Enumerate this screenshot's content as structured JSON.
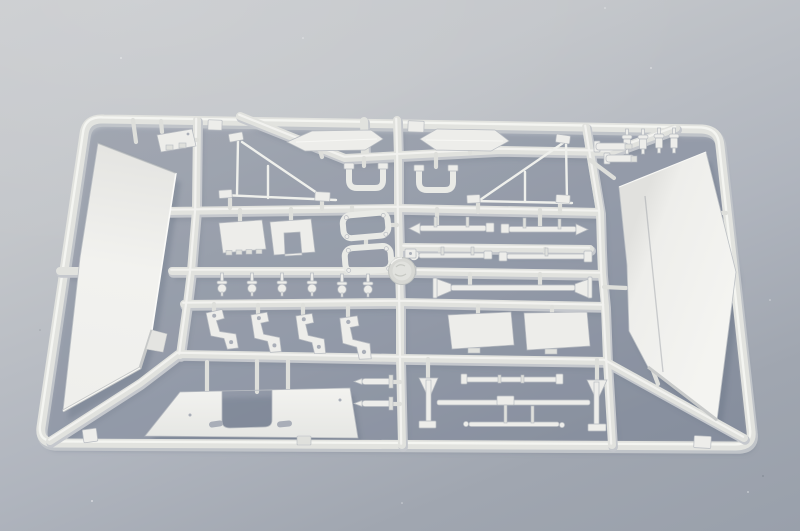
{
  "meta": {
    "domain": "natural-image",
    "description": "Overhead photograph of an unassembled light-gray injection-molded plastic model kit sprue (parts tree) lying on a blue-gray studio surface, lit from the upper left, frame tilted in slight perspective",
    "subject": "plastic model kit sprue with armored-vehicle parts",
    "text_visible": "none"
  },
  "palette": {
    "background_top": "#c8cacd",
    "background_bottom": "#99a0ab",
    "interior_tint": "rgba(115,130,155,0.14)",
    "plastic_bright": "#f5f5f2",
    "plastic_main": "#e1e2de",
    "plastic_mid": "#dfe0dc",
    "plastic_shadow_edge": "#c6c8c8",
    "medallion_fill": "#d7d8d4",
    "cast_shadow": "rgba(95,105,125,0.30)"
  },
  "sprue": {
    "frame_shape": "rounded-rectangle runner frame, wider at bottom due to camera perspective",
    "grid": {
      "horizontal_runners": 5,
      "vertical_runners": 3,
      "corner_diagonals": 4
    },
    "medallion": {
      "shape": "embossed circular maker's stamp",
      "position": "crossing of the central vertical and middle horizontal runner"
    }
  },
  "parts": [
    {
      "id": "large-panel-left",
      "label": "Large tapered side panel",
      "count": 1,
      "location": "left column"
    },
    {
      "id": "large-panel-right",
      "label": "Large tapered side panel (mirrored)",
      "count": 1,
      "location": "right column"
    },
    {
      "id": "floor-plate",
      "label": "Wide floor plate with arched cut-out and two slots",
      "count": 1,
      "location": "bottom center-left"
    },
    {
      "id": "small-plate",
      "label": "Small rectangular plate",
      "count": 1,
      "location": "top left"
    },
    {
      "id": "fender-panels",
      "label": "Pointed fender panels",
      "count": 2,
      "location": "top center"
    },
    {
      "id": "truss-frames",
      "label": "Triangular A-frame trusses",
      "count": 2,
      "location": "upper left and upper right"
    },
    {
      "id": "valve-studs",
      "label": "Flanged cylinder studs",
      "count": 4,
      "location": "top right"
    },
    {
      "id": "pipe-fittings",
      "label": "Horizontal pipe fittings",
      "count": 2,
      "location": "top right"
    },
    {
      "id": "u-shackles",
      "label": "U-shaped shackle frames",
      "count": 2,
      "location": "upper center"
    },
    {
      "id": "hatch-rings",
      "label": "Rounded hatch ring frames",
      "count": 2,
      "location": "left of medallion"
    },
    {
      "id": "hatch-solid",
      "label": "Trapezoid hatch plate with toothed edge",
      "count": 1,
      "location": "center left"
    },
    {
      "id": "hatch-notched",
      "label": "Trapezoid hatch plate with U cut-out",
      "count": 1,
      "location": "center left"
    },
    {
      "id": "linkage-rods",
      "label": "Long linkage rods with end fittings",
      "count": 4,
      "location": "center right"
    },
    {
      "id": "funnel-shaft",
      "label": "Shaft with trumpet-flared ends",
      "count": 1,
      "location": "center right"
    },
    {
      "id": "suspension-studs",
      "label": "Small mushroom studs",
      "count": 6,
      "location": "below middle runner, left"
    },
    {
      "id": "angle-brackets",
      "label": "Angled bracket plates with holes",
      "count": 4,
      "location": "lower left of center"
    },
    {
      "id": "small-trapezoid-panels",
      "label": "Small trapezoid panels",
      "count": 2,
      "location": "lower right of center"
    },
    {
      "id": "finned-darts",
      "label": "Small finned dart parts",
      "count": 2,
      "location": "bottom center"
    },
    {
      "id": "capped-rod",
      "label": "Axle rod with end caps",
      "count": 1,
      "location": "bottom center-right"
    },
    {
      "id": "towing-frame",
      "label": "H-shaped towing frame with gusseted uprights",
      "count": 1,
      "location": "bottom right of center"
    },
    {
      "id": "clamp-blocks",
      "label": "Small clamp blocks",
      "count": 2,
      "location": "beside central vertical runner"
    },
    {
      "id": "gate-tabs",
      "label": "Square identification tabs on runners",
      "count": 4,
      "location": "frame edges"
    },
    {
      "id": "medallion",
      "label": "Embossed circular maker's stamp",
      "count": 1,
      "location": "center runner crossing"
    }
  ]
}
